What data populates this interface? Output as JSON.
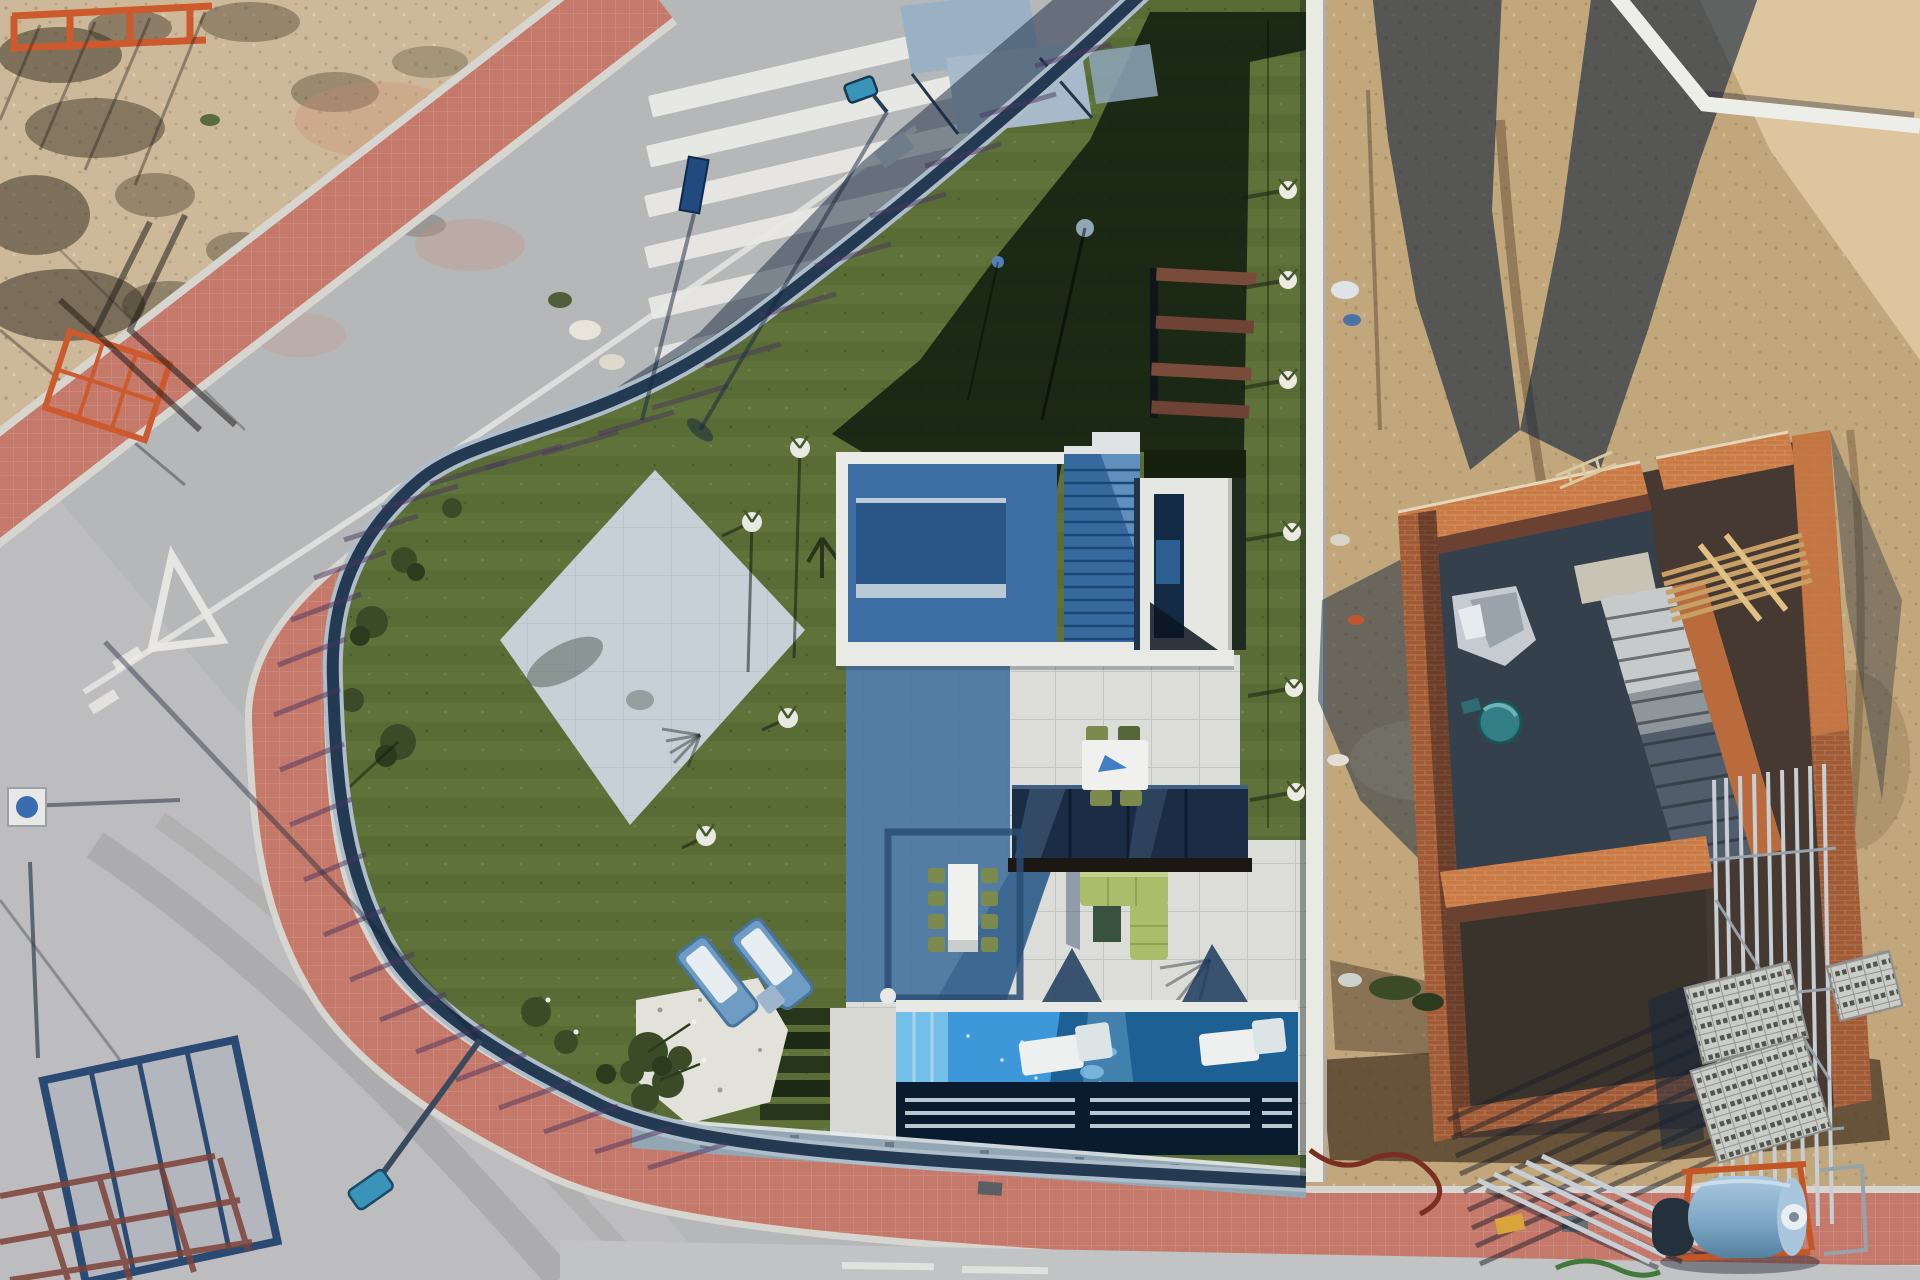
{
  "meta": {
    "title": "Aerial drone view of a modern corner villa with pool, lawn and curved street, beside a brick house under construction",
    "type": "aerial-photograph",
    "visible_text": "none"
  },
  "colors": {
    "road": "#b6b7b9",
    "roadLight": "#c2c3c4",
    "sandLot": "#cdb999",
    "sandSite": "#c2a77c",
    "sandBright": "#dcc59f",
    "sidewalkRed": "#c4796b",
    "curb": "#d6d5d0",
    "lawn": "#5f7239",
    "hedge": "#27351a",
    "patio": "#c7d0d6",
    "terrace": "#dcddd8",
    "roofBlue": "#3e6fa4",
    "roofBlueDark": "#2a5687",
    "parapet": "#e9eae5",
    "canopyGlass": "#1b2c44",
    "poolLit": "#3e97d9",
    "poolSteps": "#74bfe9",
    "poolShade": "#1d6093",
    "lounger": "#edf0ef",
    "tableWhite": "#f0f1ee",
    "chairOlive": "#7c8b4d",
    "sofaLime": "#a9bd6b",
    "gravel": "#e3e2da",
    "treeOlive": "#3c4b27",
    "fenceDark": "#243a52",
    "fenceRail": "#aebdc9",
    "wallGrey": "#93a6b4",
    "wallWhite": "#e9eae4",
    "shadowNavy": "#16283e",
    "slatPurple": "#554070",
    "brickLit": "#c97a45",
    "brickMid": "#a05b36",
    "brickShade": "#6b4231",
    "mortar": "#e4d6bd",
    "scaffold": "#c7ced4",
    "blockGrey": "#caccc8",
    "tankBlue": "#7fa8c7",
    "tankFrame": "#c45525",
    "zebra": "#eceae6",
    "signBlue": "#234a7e",
    "lampTeal": "#3a93b8",
    "orangeFence": "#cc5a2d",
    "woodTan": "#c89f66"
  },
  "scene": {
    "objects": [
      {
        "name": "vacant-lot",
        "desc": "sandy scrubland, top-left, with fence shadows and orange barriers"
      },
      {
        "name": "crosswalk",
        "desc": "six white zebra stripes on the street, top centre"
      },
      {
        "name": "street",
        "desc": "curved grey asphalt road wrapping the corner plot"
      },
      {
        "name": "yield-marking",
        "desc": "white give-way triangle and dashes painted mid-left"
      },
      {
        "name": "red-sidewalk",
        "desc": "red brick pavement band on both sides of the street"
      },
      {
        "name": "privacy-fence",
        "desc": "dark slatted fence around villa casting striped shadows"
      },
      {
        "name": "villa-lawn",
        "desc": "artificial turf garden, partly in building shadow"
      },
      {
        "name": "paved-patio",
        "desc": "light diamond-shaped paved area on the lawn"
      },
      {
        "name": "villa-roof",
        "desc": "white-parapet flat roof, blue in shadow, with stair and skylight"
      },
      {
        "name": "glass-canopy",
        "desc": "dark glazed porch roof over terrace"
      },
      {
        "name": "dining-set",
        "desc": "white table with eight olive chairs on terrace"
      },
      {
        "name": "upper-dining-set",
        "desc": "small white table with four chairs under canopy"
      },
      {
        "name": "garden-sofa",
        "desc": "L-shaped lime green lounge sofa"
      },
      {
        "name": "pergola-shadow",
        "desc": "rectangular frame shadow on terrace tiles"
      },
      {
        "name": "swimming-pool",
        "desc": "blue pool with two white in-water loungers and cascade"
      },
      {
        "name": "sun-loungers",
        "desc": "two blue-and-white loungers with side table on lawn"
      },
      {
        "name": "olive-tree",
        "desc": "tree on white gravel bed near pool"
      },
      {
        "name": "hedge-steps",
        "desc": "stepped dark hedge rows beside pool"
      },
      {
        "name": "boundary-wall",
        "desc": "white wall separating villa from construction plot"
      },
      {
        "name": "construction-building",
        "desc": "orange brick shell with staircase and deep shadows"
      },
      {
        "name": "scaffolding",
        "desc": "metal poles and pipe shadows around the brick shell"
      },
      {
        "name": "wooden-joists",
        "desc": "tan timber beams over the build"
      },
      {
        "name": "mortar-tub",
        "desc": "teal round tub inside the shell"
      },
      {
        "name": "block-pallets",
        "desc": "stacked grey hollow blocks, lower right"
      },
      {
        "name": "water-tank",
        "desc": "horizontal blue tank on orange frame, bottom right"
      },
      {
        "name": "pipe-stack",
        "desc": "metal pipes lying across the bottom sidewalk"
      },
      {
        "name": "street-lamp-top",
        "desc": "teal lamp head with long pole shadow near crosswalk"
      },
      {
        "name": "street-lamp-bottom",
        "desc": "teal lamp head with shadow, bottom left"
      },
      {
        "name": "road-sign",
        "desc": "small navy sign beside crosswalk"
      },
      {
        "name": "construction-fence-panel",
        "desc": "blue mesh fence panel with rust shadow, bottom left"
      },
      {
        "name": "neighbour-wall",
        "desc": "white V-shaped wall, top right corner"
      },
      {
        "name": "building-shadow",
        "desc": "long diagonal shadows cast across road and sand"
      }
    ]
  }
}
